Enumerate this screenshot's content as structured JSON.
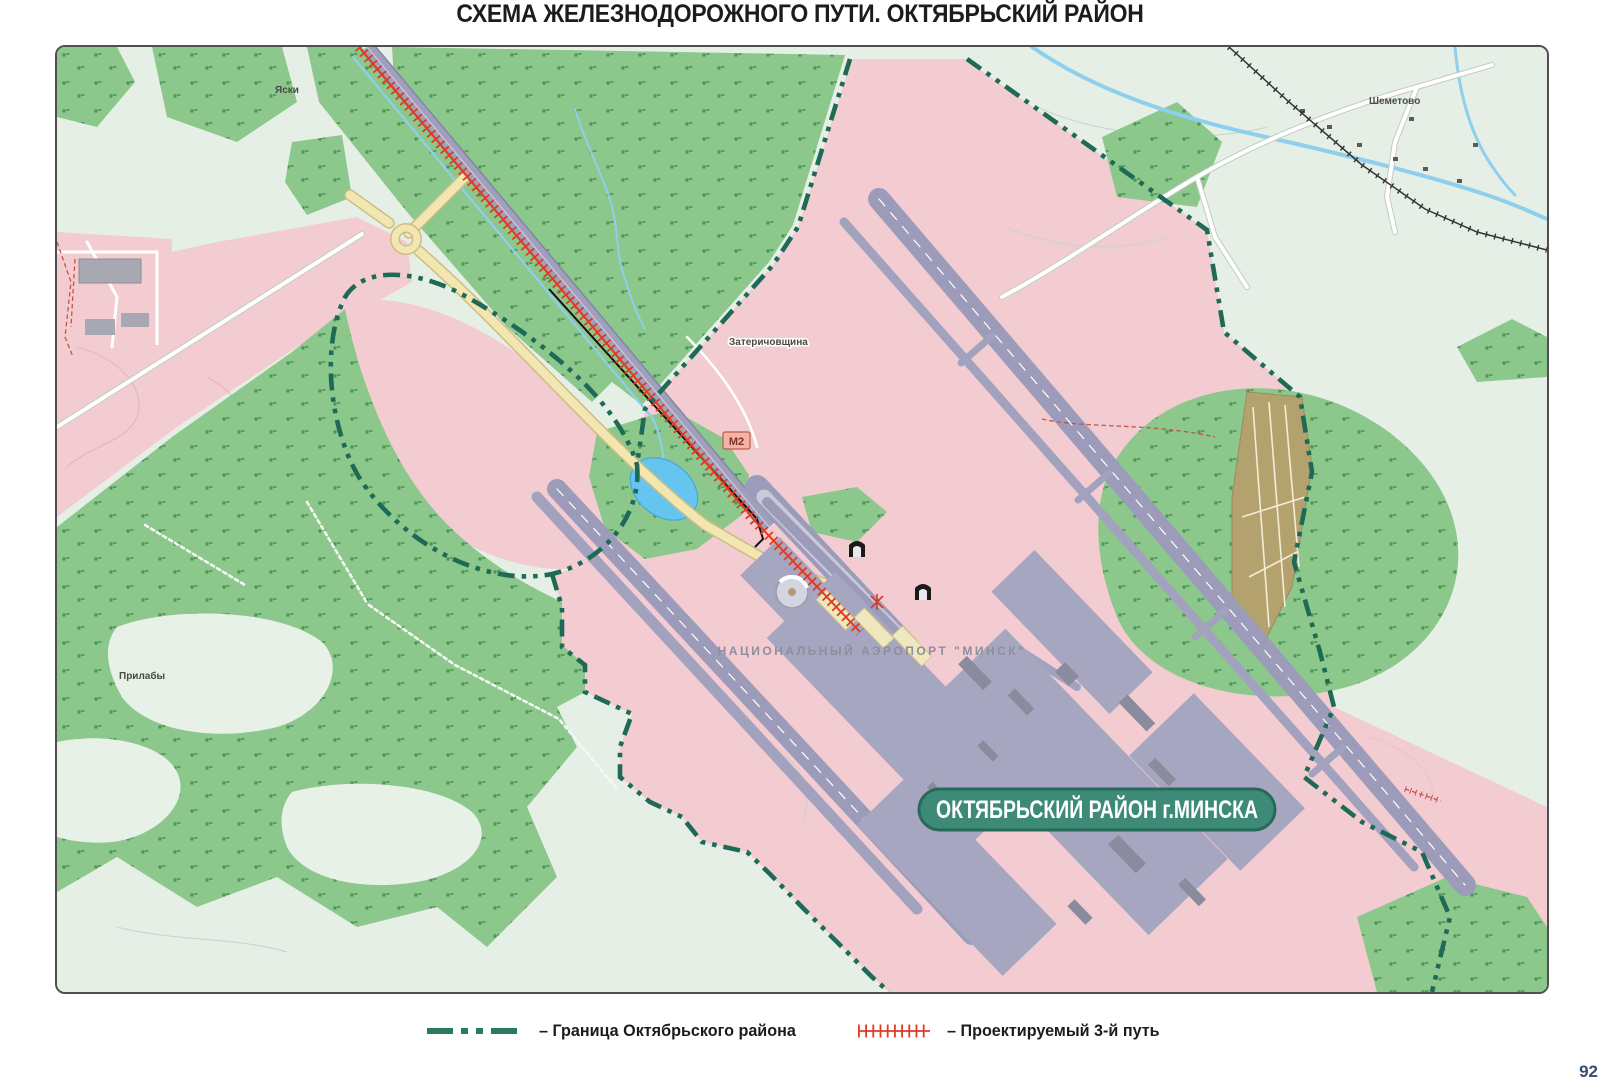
{
  "page": {
    "title": "СХЕМА ЖЕЛЕЗНОДОРОЖНОГО ПУТИ.  ОКТЯБРЬСКИЙ РАЙОН",
    "page_number": "92"
  },
  "map": {
    "labels": {
      "village_top_left": "Яски",
      "village_top_right": "Шеметово",
      "village_center": "Затеричовщина",
      "village_west": "Прилабы",
      "airport_name": "НАЦИОНАЛЬНЫЙ АЭРОПОРТ \"МИНСК\"",
      "road_shield": "М2",
      "district_badge": "ОКТЯБРЬСКИЙ РАЙОН г.МИНСКА"
    },
    "colors": {
      "district_boundary": "#1f6a57",
      "projected_track": "#e03c22",
      "forest": "#8cc78b",
      "urban_area": "#f3ccd1",
      "runway": "#9c9cba",
      "water": "#86cdec",
      "badge_fill": "#3d8a76"
    }
  },
  "legend": {
    "items": [
      {
        "symbol": "district-boundary-line",
        "label": "–  Граница Октябрьского района"
      },
      {
        "symbol": "projected-track-hatched-line",
        "label": "–  Проектируемый 3-й путь"
      }
    ]
  }
}
